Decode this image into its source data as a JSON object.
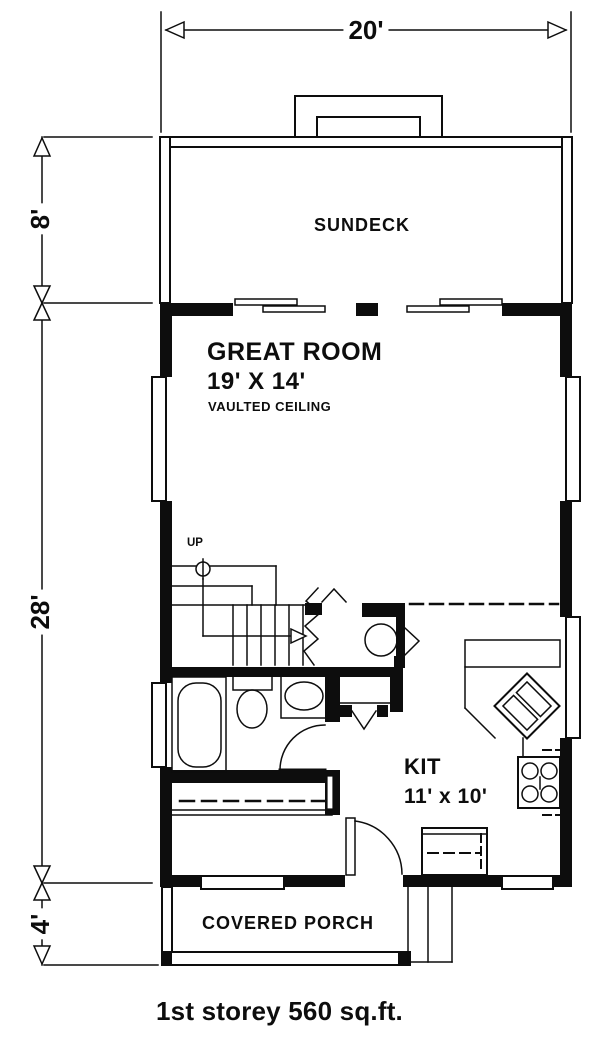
{
  "page": {
    "caption": "1st storey 560 sq.ft."
  },
  "dimensions": {
    "overall_width": "20'",
    "sundeck_depth": "8'",
    "house_depth": "28'",
    "porch_depth": "4'"
  },
  "rooms": {
    "sundeck": {
      "label": "SUNDECK"
    },
    "great_room": {
      "label": "GREAT ROOM",
      "size": "19' X 14'",
      "note": "VAULTED CEILING"
    },
    "kitchen": {
      "label": "KIT",
      "size": "11' x 10'"
    },
    "covered_porch": {
      "label": "COVERED PORCH"
    },
    "stairs": {
      "direction_label": "UP"
    }
  },
  "colors": {
    "ink": "#0d0d0d",
    "paper": "#ffffff"
  }
}
